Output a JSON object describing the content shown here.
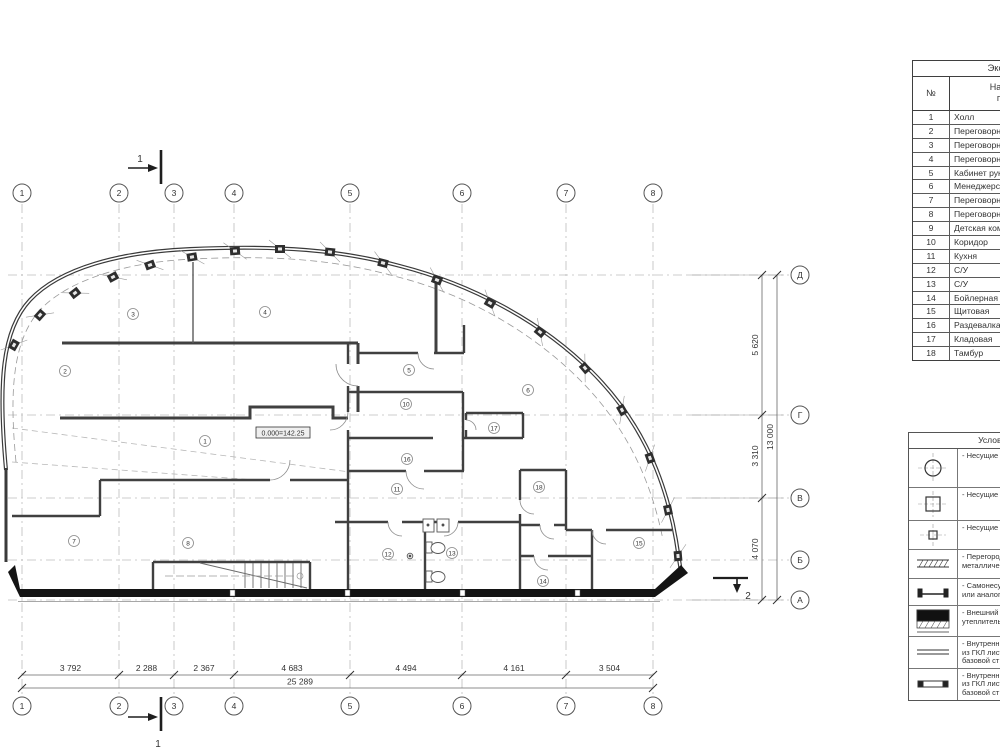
{
  "colors": {
    "wall": "#3f3f3f",
    "exterior_black": "#141414",
    "grid_line": "#b5b5b5",
    "dim_text": "#2f2f2f"
  },
  "grid": {
    "cols": [
      "1",
      "2",
      "3",
      "4",
      "5",
      "6",
      "7",
      "8"
    ],
    "rows": [
      "Д",
      "Г",
      "В",
      "Б",
      "А"
    ]
  },
  "dims": {
    "bottom": [
      "3 792",
      "2 288",
      "2 367",
      "4 683",
      "4 494",
      "4 161",
      "3 504"
    ],
    "bottom_total": "25 289",
    "right": [
      "5 620",
      "3 310",
      "4 070"
    ],
    "right_total": "13 000"
  },
  "sections": {
    "top": "1",
    "bottom": "1",
    "right": "2"
  },
  "plan": {
    "elevation": "0.000=142.25",
    "labels": [
      {
        "n": "1",
        "x": 205,
        "y": 441
      },
      {
        "n": "2",
        "x": 65,
        "y": 371
      },
      {
        "n": "3",
        "x": 133,
        "y": 314
      },
      {
        "n": "4",
        "x": 265,
        "y": 312
      },
      {
        "n": "5",
        "x": 409,
        "y": 370
      },
      {
        "n": "6",
        "x": 528,
        "y": 390
      },
      {
        "n": "7",
        "x": 74,
        "y": 541
      },
      {
        "n": "8",
        "x": 188,
        "y": 543
      },
      {
        "n": "10",
        "x": 406,
        "y": 404
      },
      {
        "n": "11",
        "x": 397,
        "y": 489
      },
      {
        "n": "12",
        "x": 388,
        "y": 554
      },
      {
        "n": "13",
        "x": 452,
        "y": 553
      },
      {
        "n": "14",
        "x": 543,
        "y": 581
      },
      {
        "n": "15",
        "x": 639,
        "y": 543
      },
      {
        "n": "16",
        "x": 407,
        "y": 459
      },
      {
        "n": "17",
        "x": 494,
        "y": 428
      },
      {
        "n": "18",
        "x": 539,
        "y": 487
      }
    ]
  },
  "room_table": {
    "title": "Экспликация помещений",
    "num_header": "№",
    "name_header_1": "Наименование",
    "name_header_2": "помещения",
    "rows": [
      {
        "num": "1",
        "name": "Холл"
      },
      {
        "num": "2",
        "name": "Переговорная"
      },
      {
        "num": "3",
        "name": "Переговорная"
      },
      {
        "num": "4",
        "name": "Переговорная"
      },
      {
        "num": "5",
        "name": "Кабинет руководителя"
      },
      {
        "num": "6",
        "name": "Менеджерская"
      },
      {
        "num": "7",
        "name": "Переговорная"
      },
      {
        "num": "8",
        "name": "Переговорная"
      },
      {
        "num": "9",
        "name": "Детская комната"
      },
      {
        "num": "10",
        "name": "Коридор"
      },
      {
        "num": "11",
        "name": "Кухня"
      },
      {
        "num": "12",
        "name": "С/У"
      },
      {
        "num": "13",
        "name": "С/У"
      },
      {
        "num": "14",
        "name": "Бойлерная"
      },
      {
        "num": "15",
        "name": "Щитовая"
      },
      {
        "num": "16",
        "name": "Раздевалка"
      },
      {
        "num": "17",
        "name": "Кладовая"
      },
      {
        "num": "18",
        "name": "Тамбур"
      }
    ]
  },
  "legend": {
    "title": "Условные обозначения",
    "rows": [
      {
        "icon": "column-round-icon",
        "l1": "- Несущие",
        "l2": "",
        "l3": ""
      },
      {
        "icon": "column-square-icon",
        "l1": "- Несущие",
        "l2": "",
        "l3": ""
      },
      {
        "icon": "column-small-icon",
        "l1": "- Несущие",
        "l2": "",
        "l3": ""
      },
      {
        "icon": "partition-hatched-icon",
        "l1": "- Перегород",
        "l2": "металличе",
        "l3": ""
      },
      {
        "icon": "partition-bracket-icon",
        "l1": "- Самонесу",
        "l2": "или аналог",
        "l3": ""
      },
      {
        "icon": "external-wall-icon",
        "l1": "- Внешний",
        "l2": "утеплитель",
        "l3": ""
      },
      {
        "icon": "gkl-wall-icon",
        "l1": "- Внутренн",
        "l2": "из ГКЛ лист",
        "l3": "базовой ст"
      },
      {
        "icon": "gkl-wall2-icon",
        "l1": "- Внутренн",
        "l2": "из ГКЛ лист",
        "l3": "базовой ст"
      }
    ]
  }
}
